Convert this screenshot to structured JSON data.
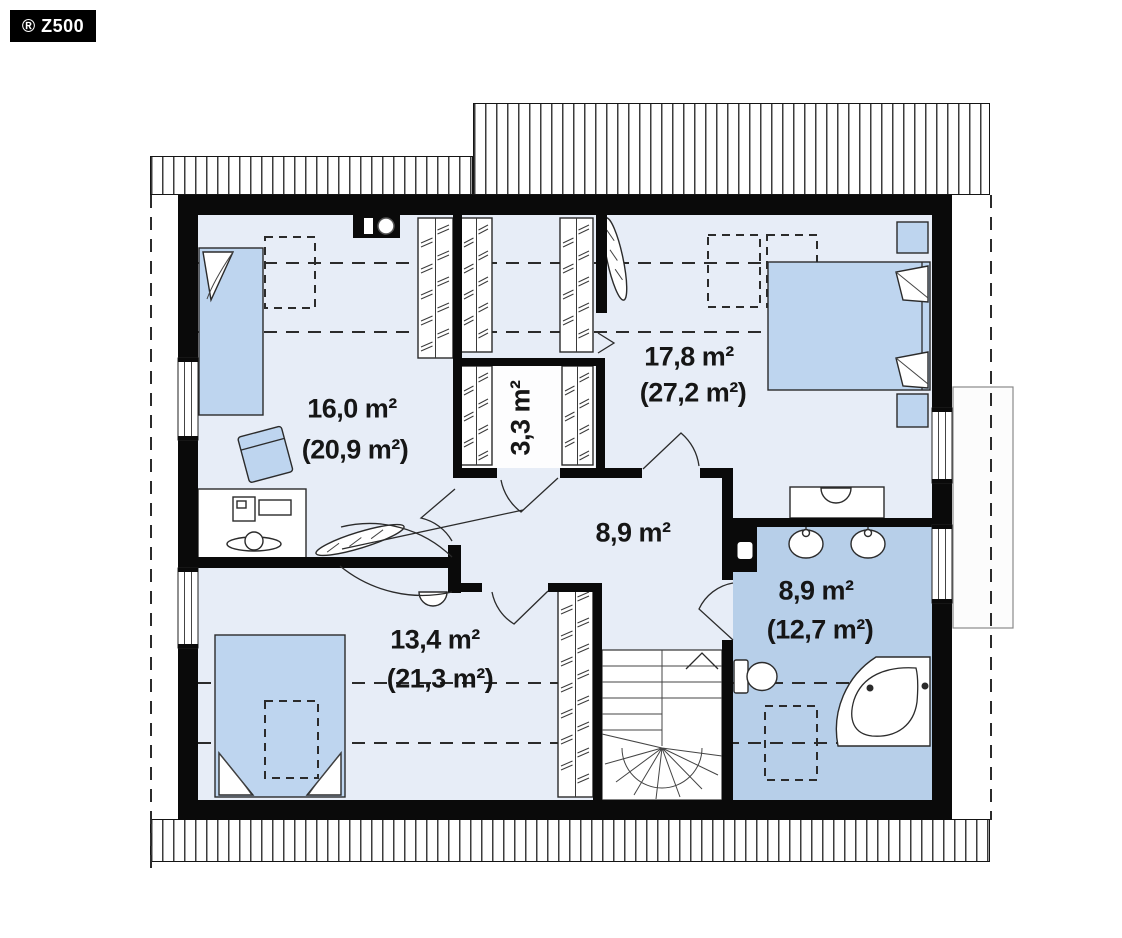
{
  "badge": {
    "text": "® Z500"
  },
  "floor_plan": {
    "type": "attic floor plan",
    "rooms": [
      {
        "name": "bedroom-top-left",
        "area": "16,0 m²",
        "floor_area": "(20,9 m²)"
      },
      {
        "name": "bedroom-top-right",
        "area": "17,8 m²",
        "floor_area": "(27,2 m²)"
      },
      {
        "name": "walk-in-closet",
        "area": "3,3 m²"
      },
      {
        "name": "hall",
        "area": "8,9 m²"
      },
      {
        "name": "bedroom-bottom-left",
        "area": "13,4 m²",
        "floor_area": "(21,3 m²)"
      },
      {
        "name": "bathroom",
        "area": "8,9 m²",
        "floor_area": "(12,7 m²)"
      }
    ],
    "colors": {
      "wall": "#0a0a0a",
      "floor": "#e7edf7",
      "furniture": "#bed5ef",
      "bath_floor": "#b7cfe9",
      "line": "#2b2b2b"
    }
  }
}
